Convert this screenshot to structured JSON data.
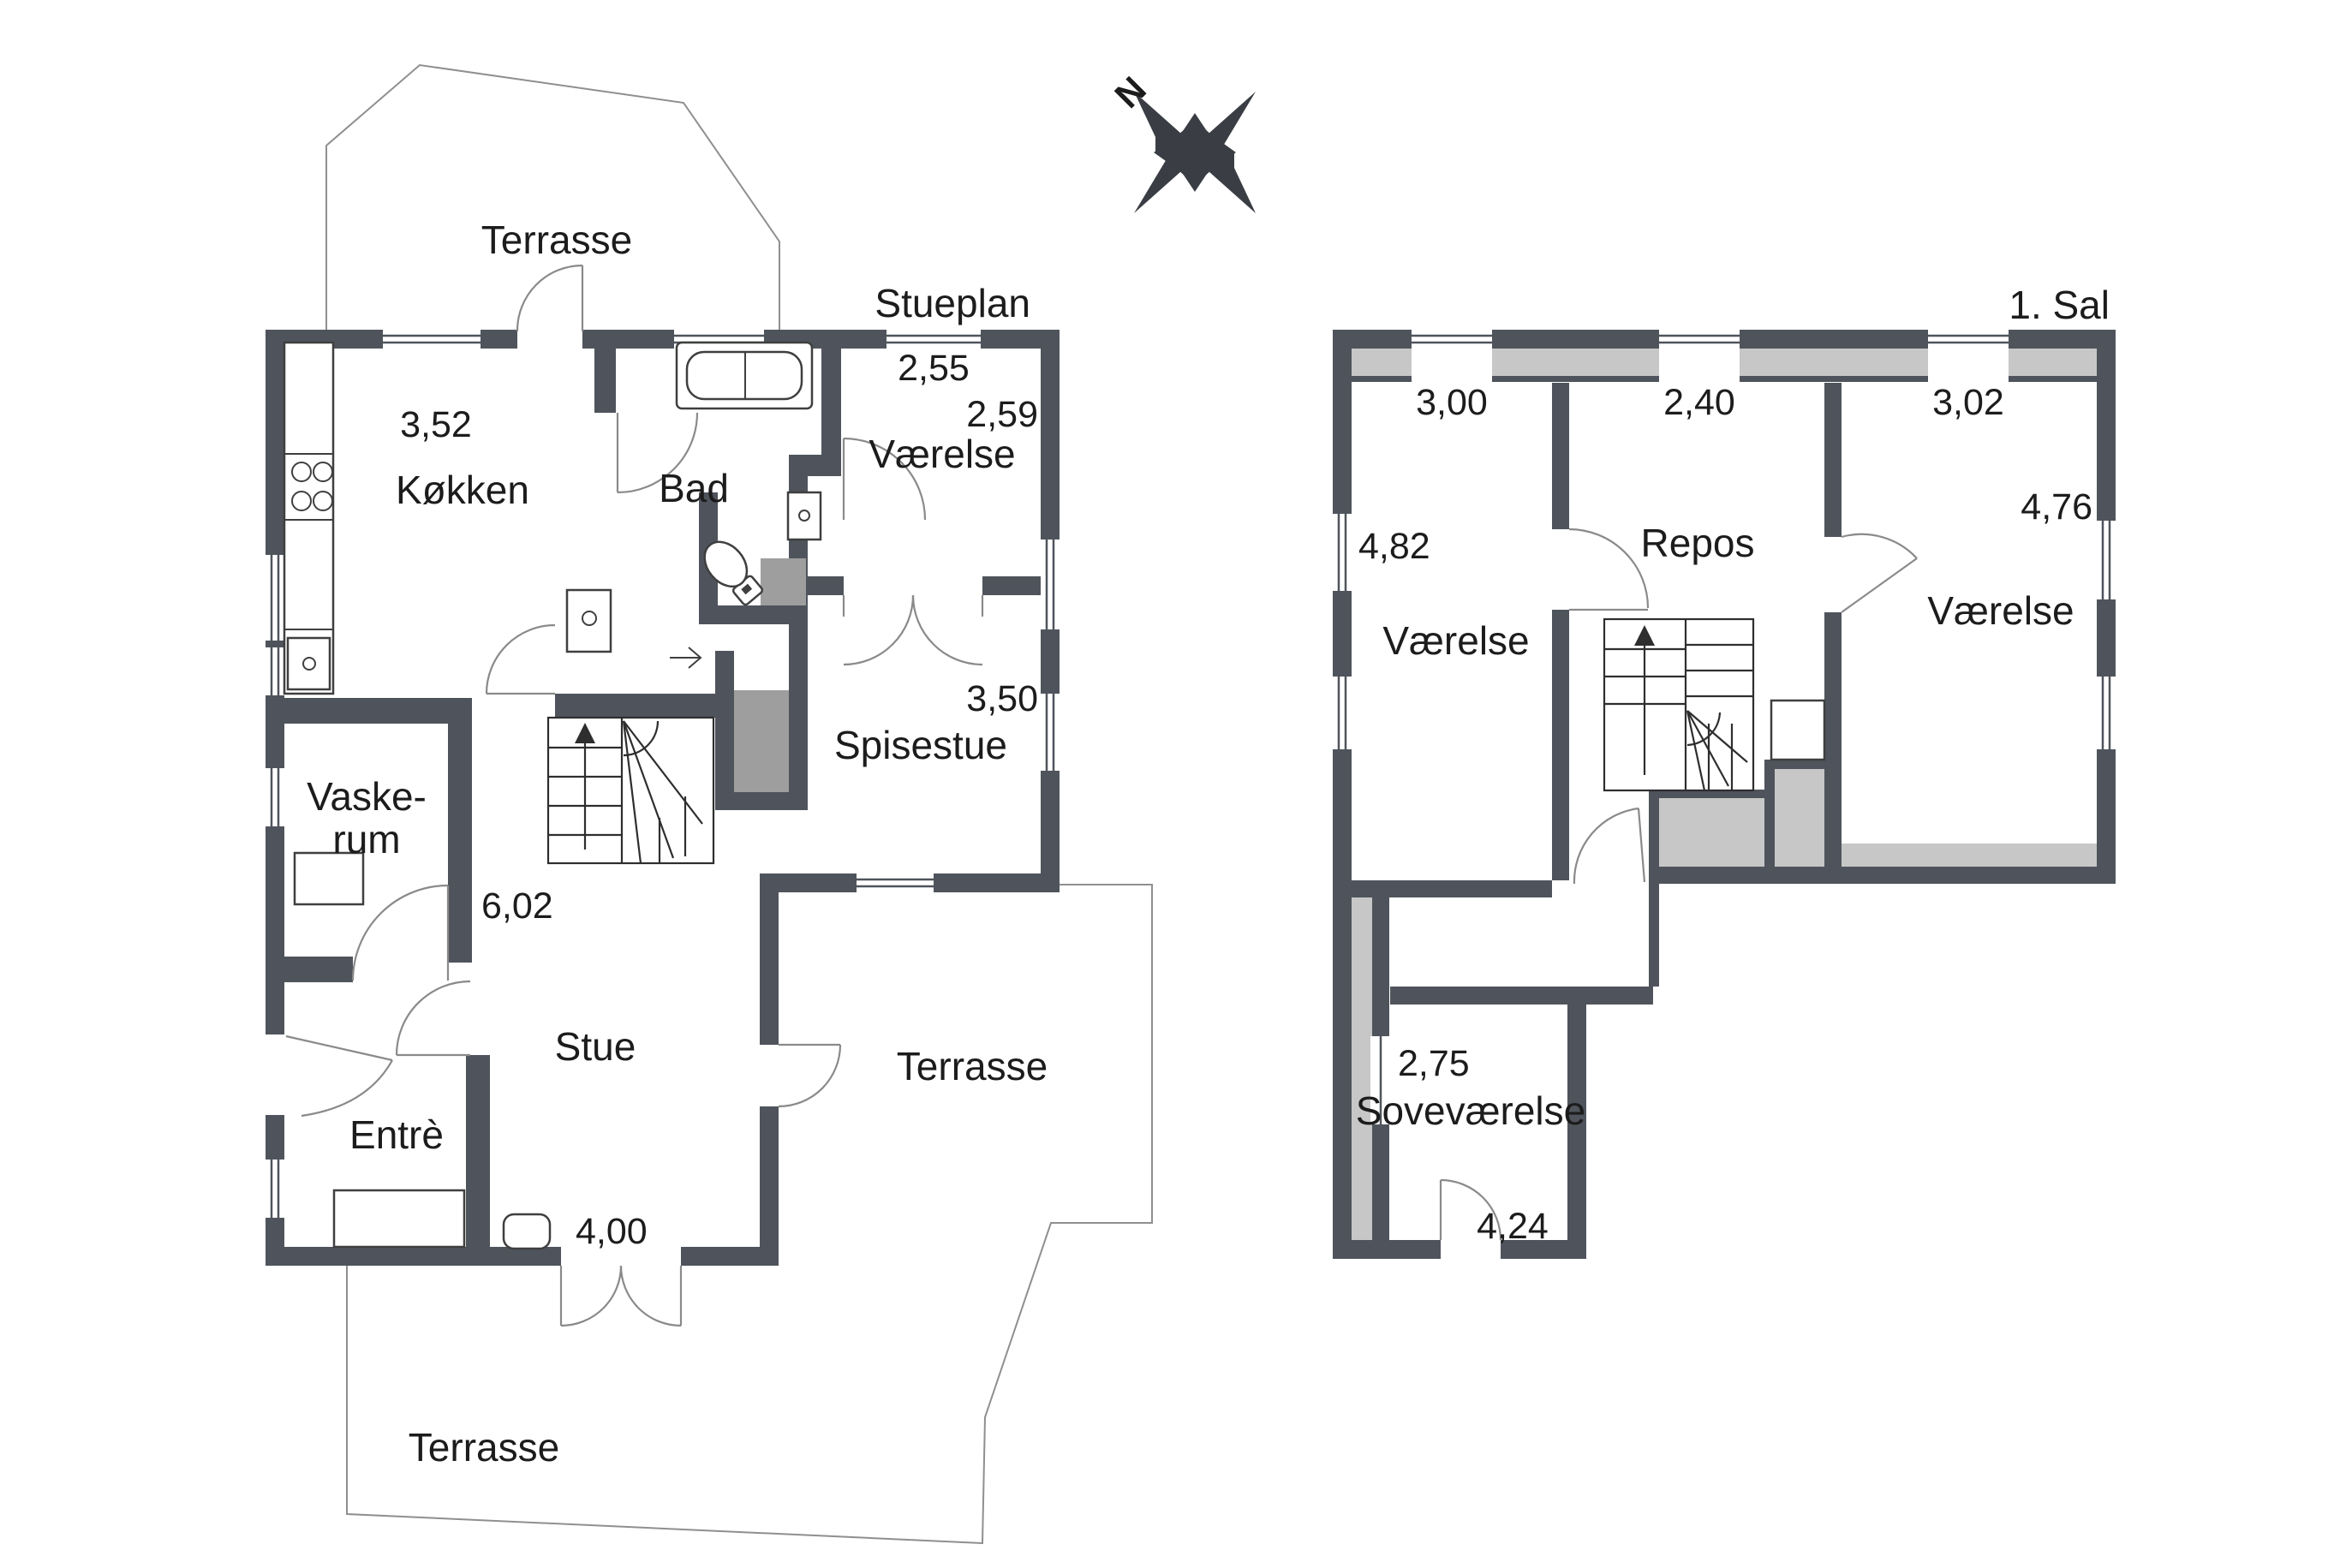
{
  "compass": {
    "north": "N"
  },
  "colors": {
    "wall": "#4f545c",
    "low_ceiling_gray": "#c7c7c7",
    "shaft_gray": "#9e9e9e",
    "line": "#8f8f8f"
  },
  "ground_floor": {
    "title": "Stueplan",
    "rooms": {
      "terrace_top": "Terrasse",
      "kitchen": "Køkken",
      "bath": "Bad",
      "bedroom": "Værelse",
      "dining": "Spisestue",
      "laundry_line1": "Vaske-",
      "laundry_line2": "rum",
      "living": "Stue",
      "entry": "Entrè",
      "terrace_right": "Terrasse",
      "terrace_bottom": "Terrasse"
    },
    "dims": {
      "kitchen_window": "3,52",
      "bedroom_width": "2,55",
      "bedroom_depth": "2,59",
      "dining_depth": "3,50",
      "living_height": "6,02",
      "living_width": "4,00"
    }
  },
  "first_floor": {
    "title": "1. Sal",
    "rooms": {
      "bedroom_left": "Værelse",
      "landing": "Repos",
      "bedroom_right": "Værelse",
      "master": "Soveværelse"
    },
    "dims": {
      "window_left": "3,00",
      "window_mid": "2,40",
      "window_right": "3,02",
      "depth_left": "4,82",
      "depth_right": "4,76",
      "master_width": "2,75",
      "master_length": "4,24"
    }
  }
}
